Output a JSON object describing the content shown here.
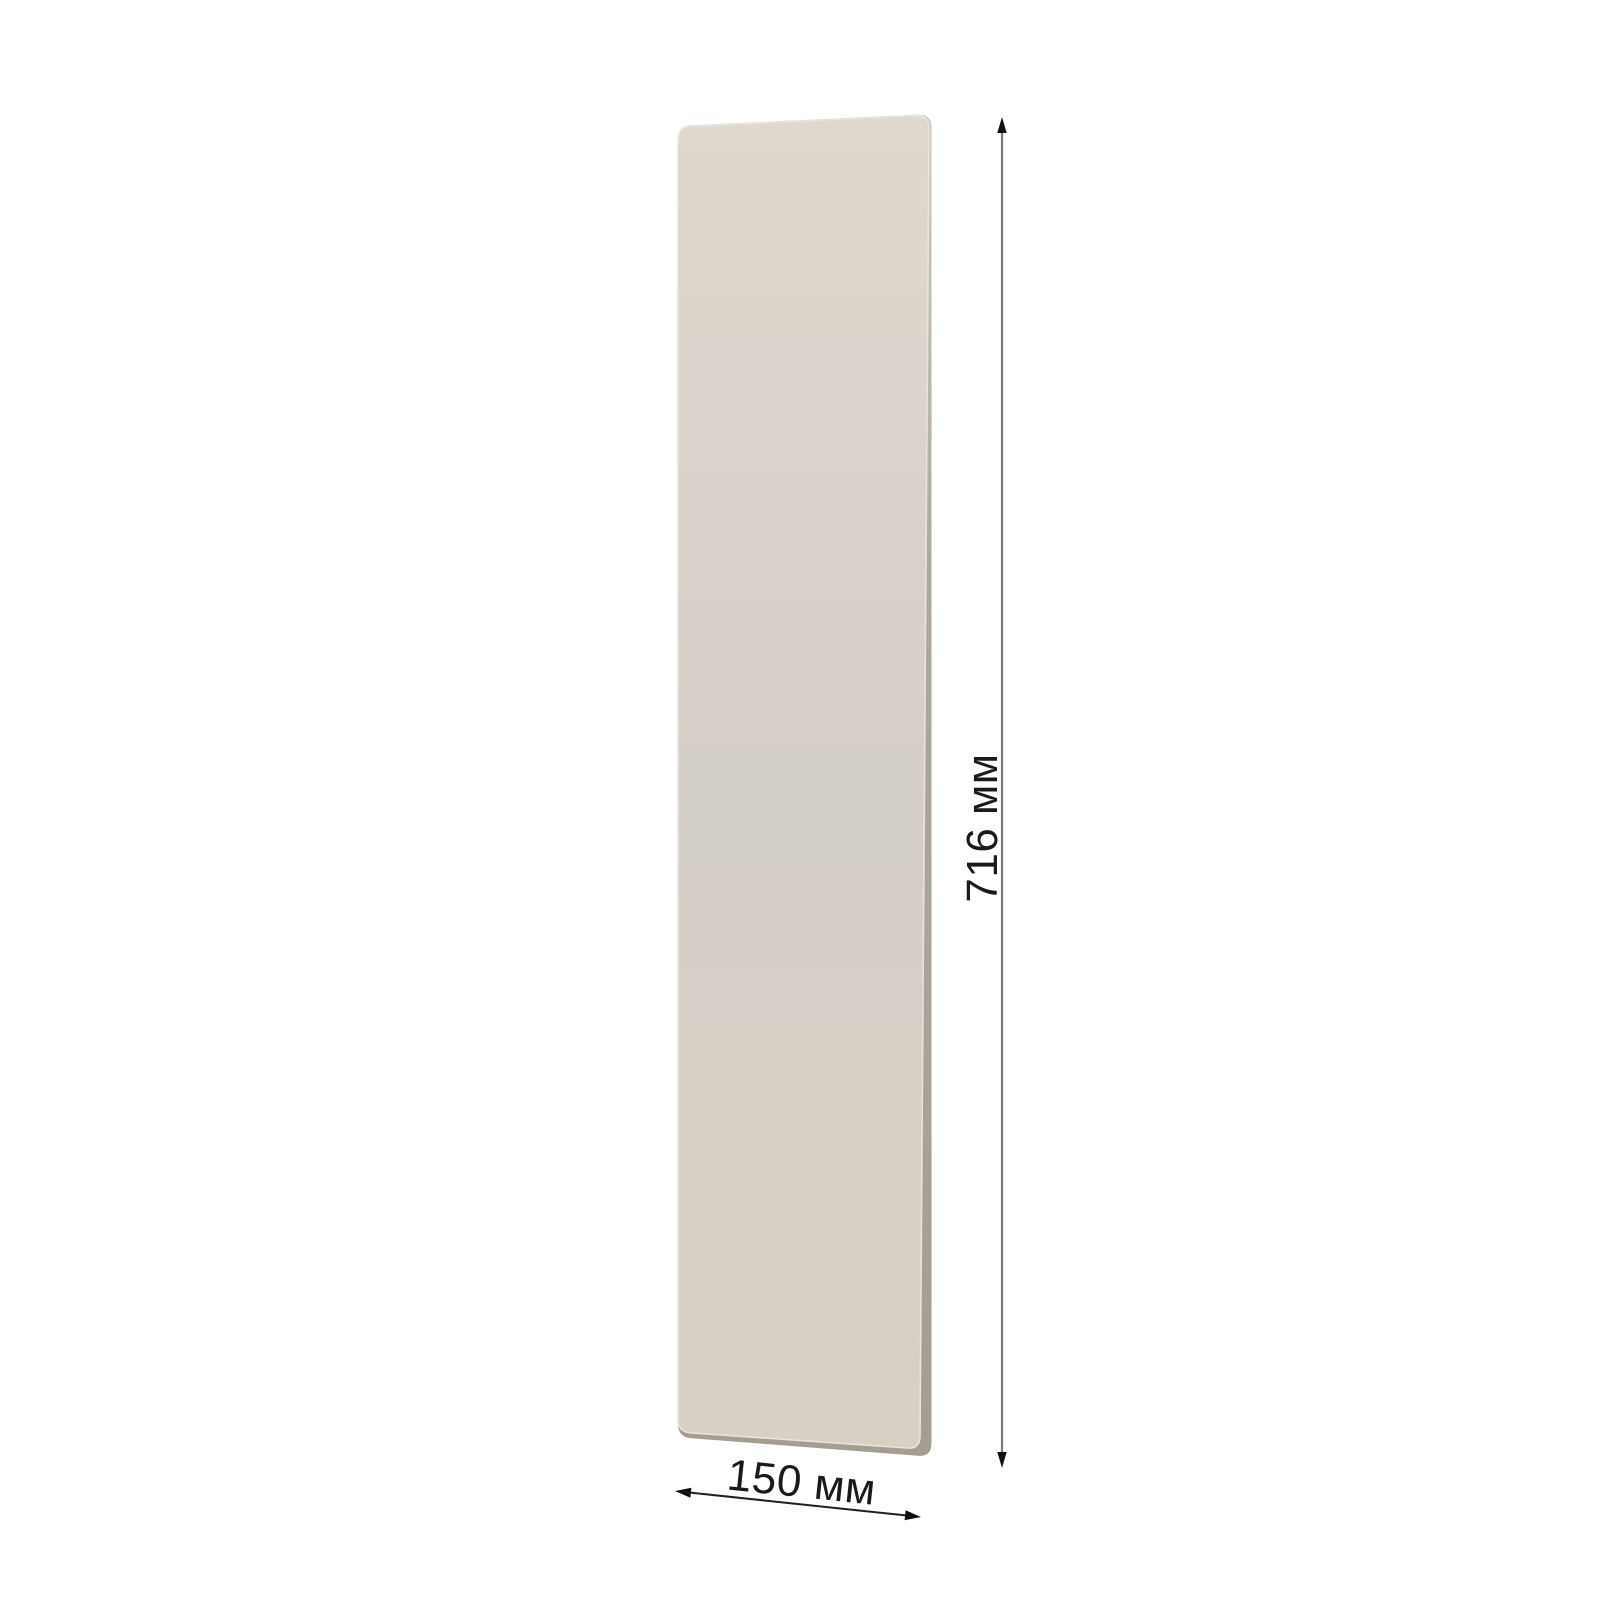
{
  "page": {
    "background_color": "#ffffff"
  },
  "panel": {
    "face_gradient": {
      "top": "#DED8CE",
      "mid": "#D4CEC8",
      "bottom": "#D7D0C4"
    },
    "edge_gradient": {
      "top": "#CFCAC1",
      "mid": "#ACA79E",
      "bottom": "#A49D92"
    },
    "bevel_highlight_color": "#E9E3D9"
  },
  "dimensions": {
    "height_label": "716 мм",
    "width_label": "150 мм",
    "height_line_color": "#7B7B78",
    "width_line_color": "#1F1F1F",
    "arrow_color": "#111111",
    "label_color": "#1A1A1A"
  }
}
